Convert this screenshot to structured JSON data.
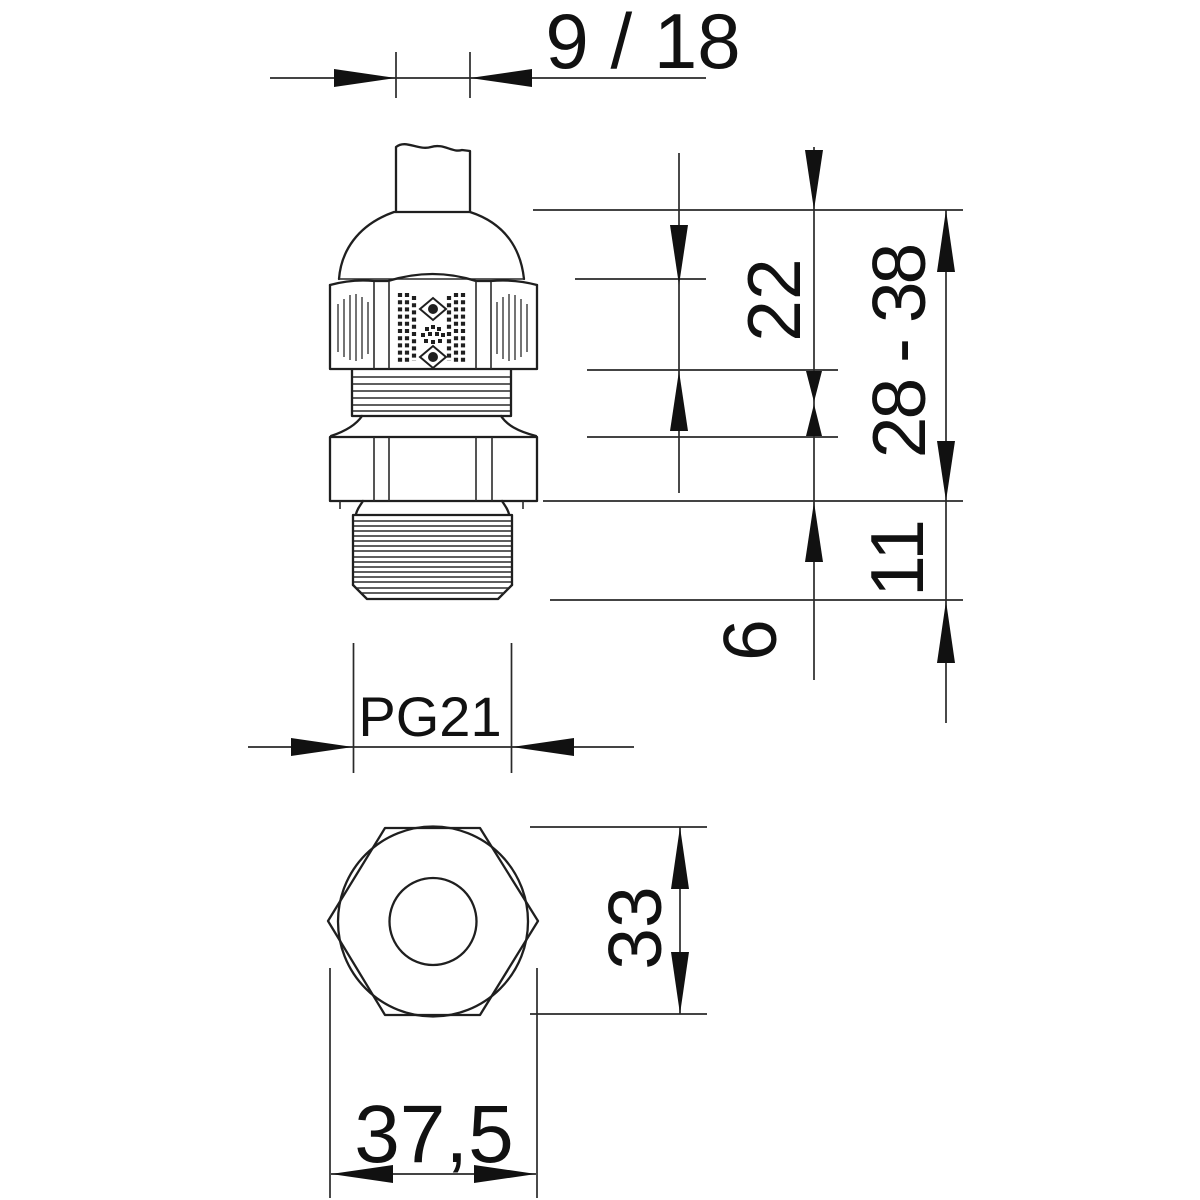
{
  "drawing": {
    "type": "technical-dimension-drawing",
    "background_color": "#ffffff",
    "line_color": "#1f1f1f",
    "text_color": "#111111",
    "views": {
      "side_view": "cable gland side elevation with cable stub, dome cap, knurled hex nut, ribbed ring, hex flange and external thread",
      "bottom_view": "hexagon with outer circle and inner cable bore circle"
    },
    "labels": {
      "clamp_range_top": "9 / 18",
      "nut_height": "22",
      "height_range": "28 - 38",
      "lower_section": "11",
      "flange": "6",
      "thread": "PG21",
      "across_flats": "33",
      "across_corners": "37,5"
    }
  }
}
